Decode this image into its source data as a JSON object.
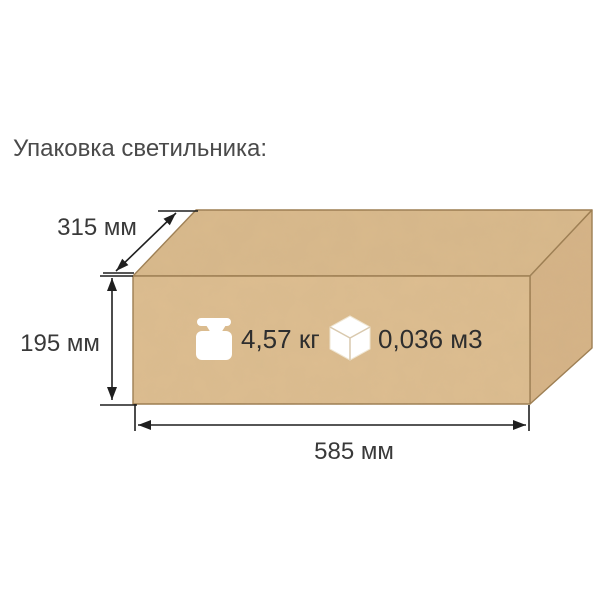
{
  "title": "Упаковка светильника:",
  "diagram": {
    "dimension_depth": "315 мм",
    "dimension_height": "195 мм",
    "dimension_width": "585 мм",
    "weight": "4,57 кг",
    "volume": "0,036 м3"
  },
  "colors": {
    "box_top": "#d9b98c",
    "box_front": "#ddbd90",
    "box_right": "#d6b487",
    "box_edge": "#9b7c50",
    "dimension_line": "#1f1f1f",
    "icon": "#ffffff"
  }
}
